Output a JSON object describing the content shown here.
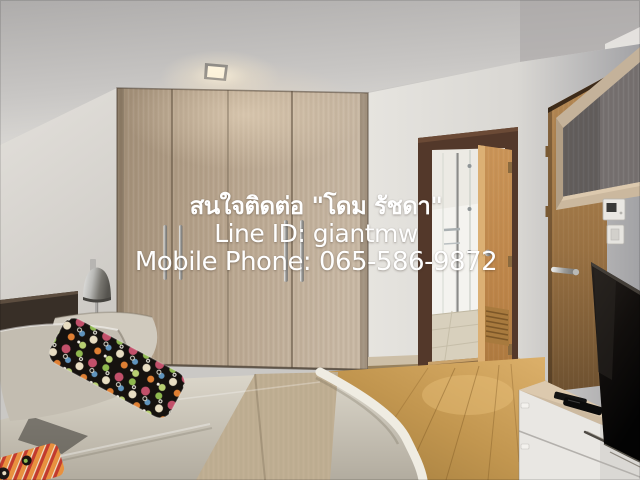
{
  "overlay": {
    "contact": "สนใจติดต่อ \"โดม รัชดา\"",
    "line_id": "Line ID: giantmw",
    "phone": "Mobile Phone: 065-586-9872"
  },
  "palette": {
    "overlay_text": "#ffffff",
    "wardrobe_wood": "#b7a38d",
    "left_wall": "#dbd8d3",
    "ceiling": "#c6c4c2",
    "back_wall": "#e2e0db",
    "right_wall_grey": "#a9a8aa",
    "door_frame_dark": "#513728",
    "bathroom_door_tan": "#c08a55",
    "entrance_door_brown": "#9c7445",
    "wood_floor": "#c79a58",
    "bedding": "#cfc9bd",
    "bed_runner": "#bfae92",
    "headboard": "#332a23",
    "tv_screen": "#0d0b0a",
    "cabinet_front": "#e9e7e3",
    "accent_pillow_red": "#c2506a",
    "accent_pillow_green": "#8fb94f",
    "accent_pillow_orange": "#df7f33"
  }
}
